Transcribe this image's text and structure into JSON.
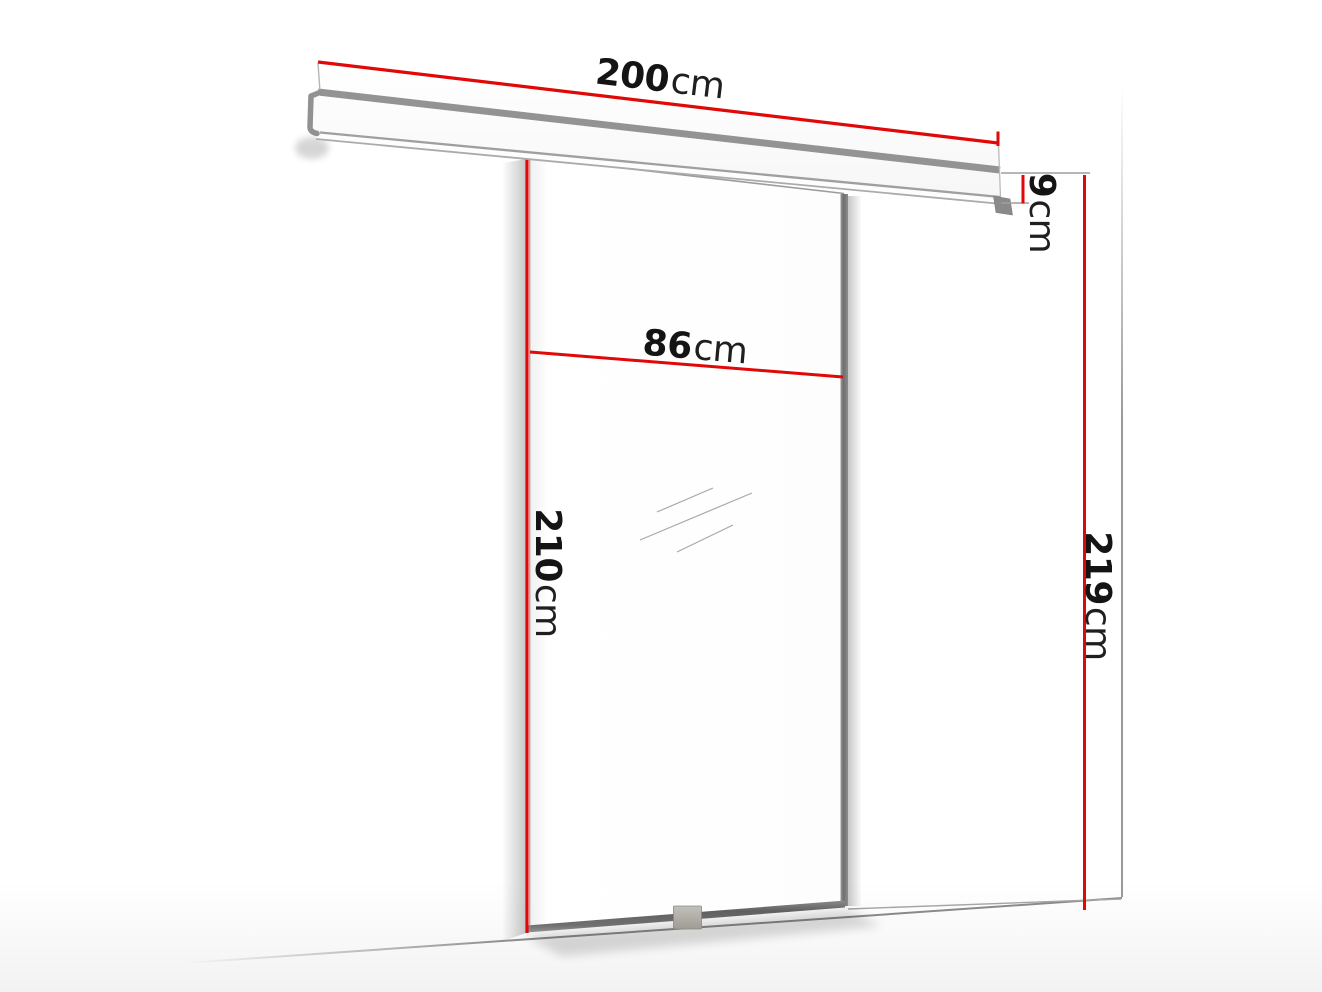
{
  "page": {
    "title": "Sliding door dimension diagram"
  },
  "colors": {
    "dimension_line": "#e10808",
    "outline_gray": "#9a9a9a",
    "label_text": "#141414"
  },
  "dimensions": {
    "track_width": {
      "value": "200",
      "unit": "cm"
    },
    "door_width": {
      "value": "86",
      "unit": "cm"
    },
    "door_height": {
      "value": "210",
      "unit": "cm"
    },
    "track_height": {
      "value": "9",
      "unit": "cm"
    },
    "total_height": {
      "value": "219",
      "unit": "cm"
    }
  }
}
